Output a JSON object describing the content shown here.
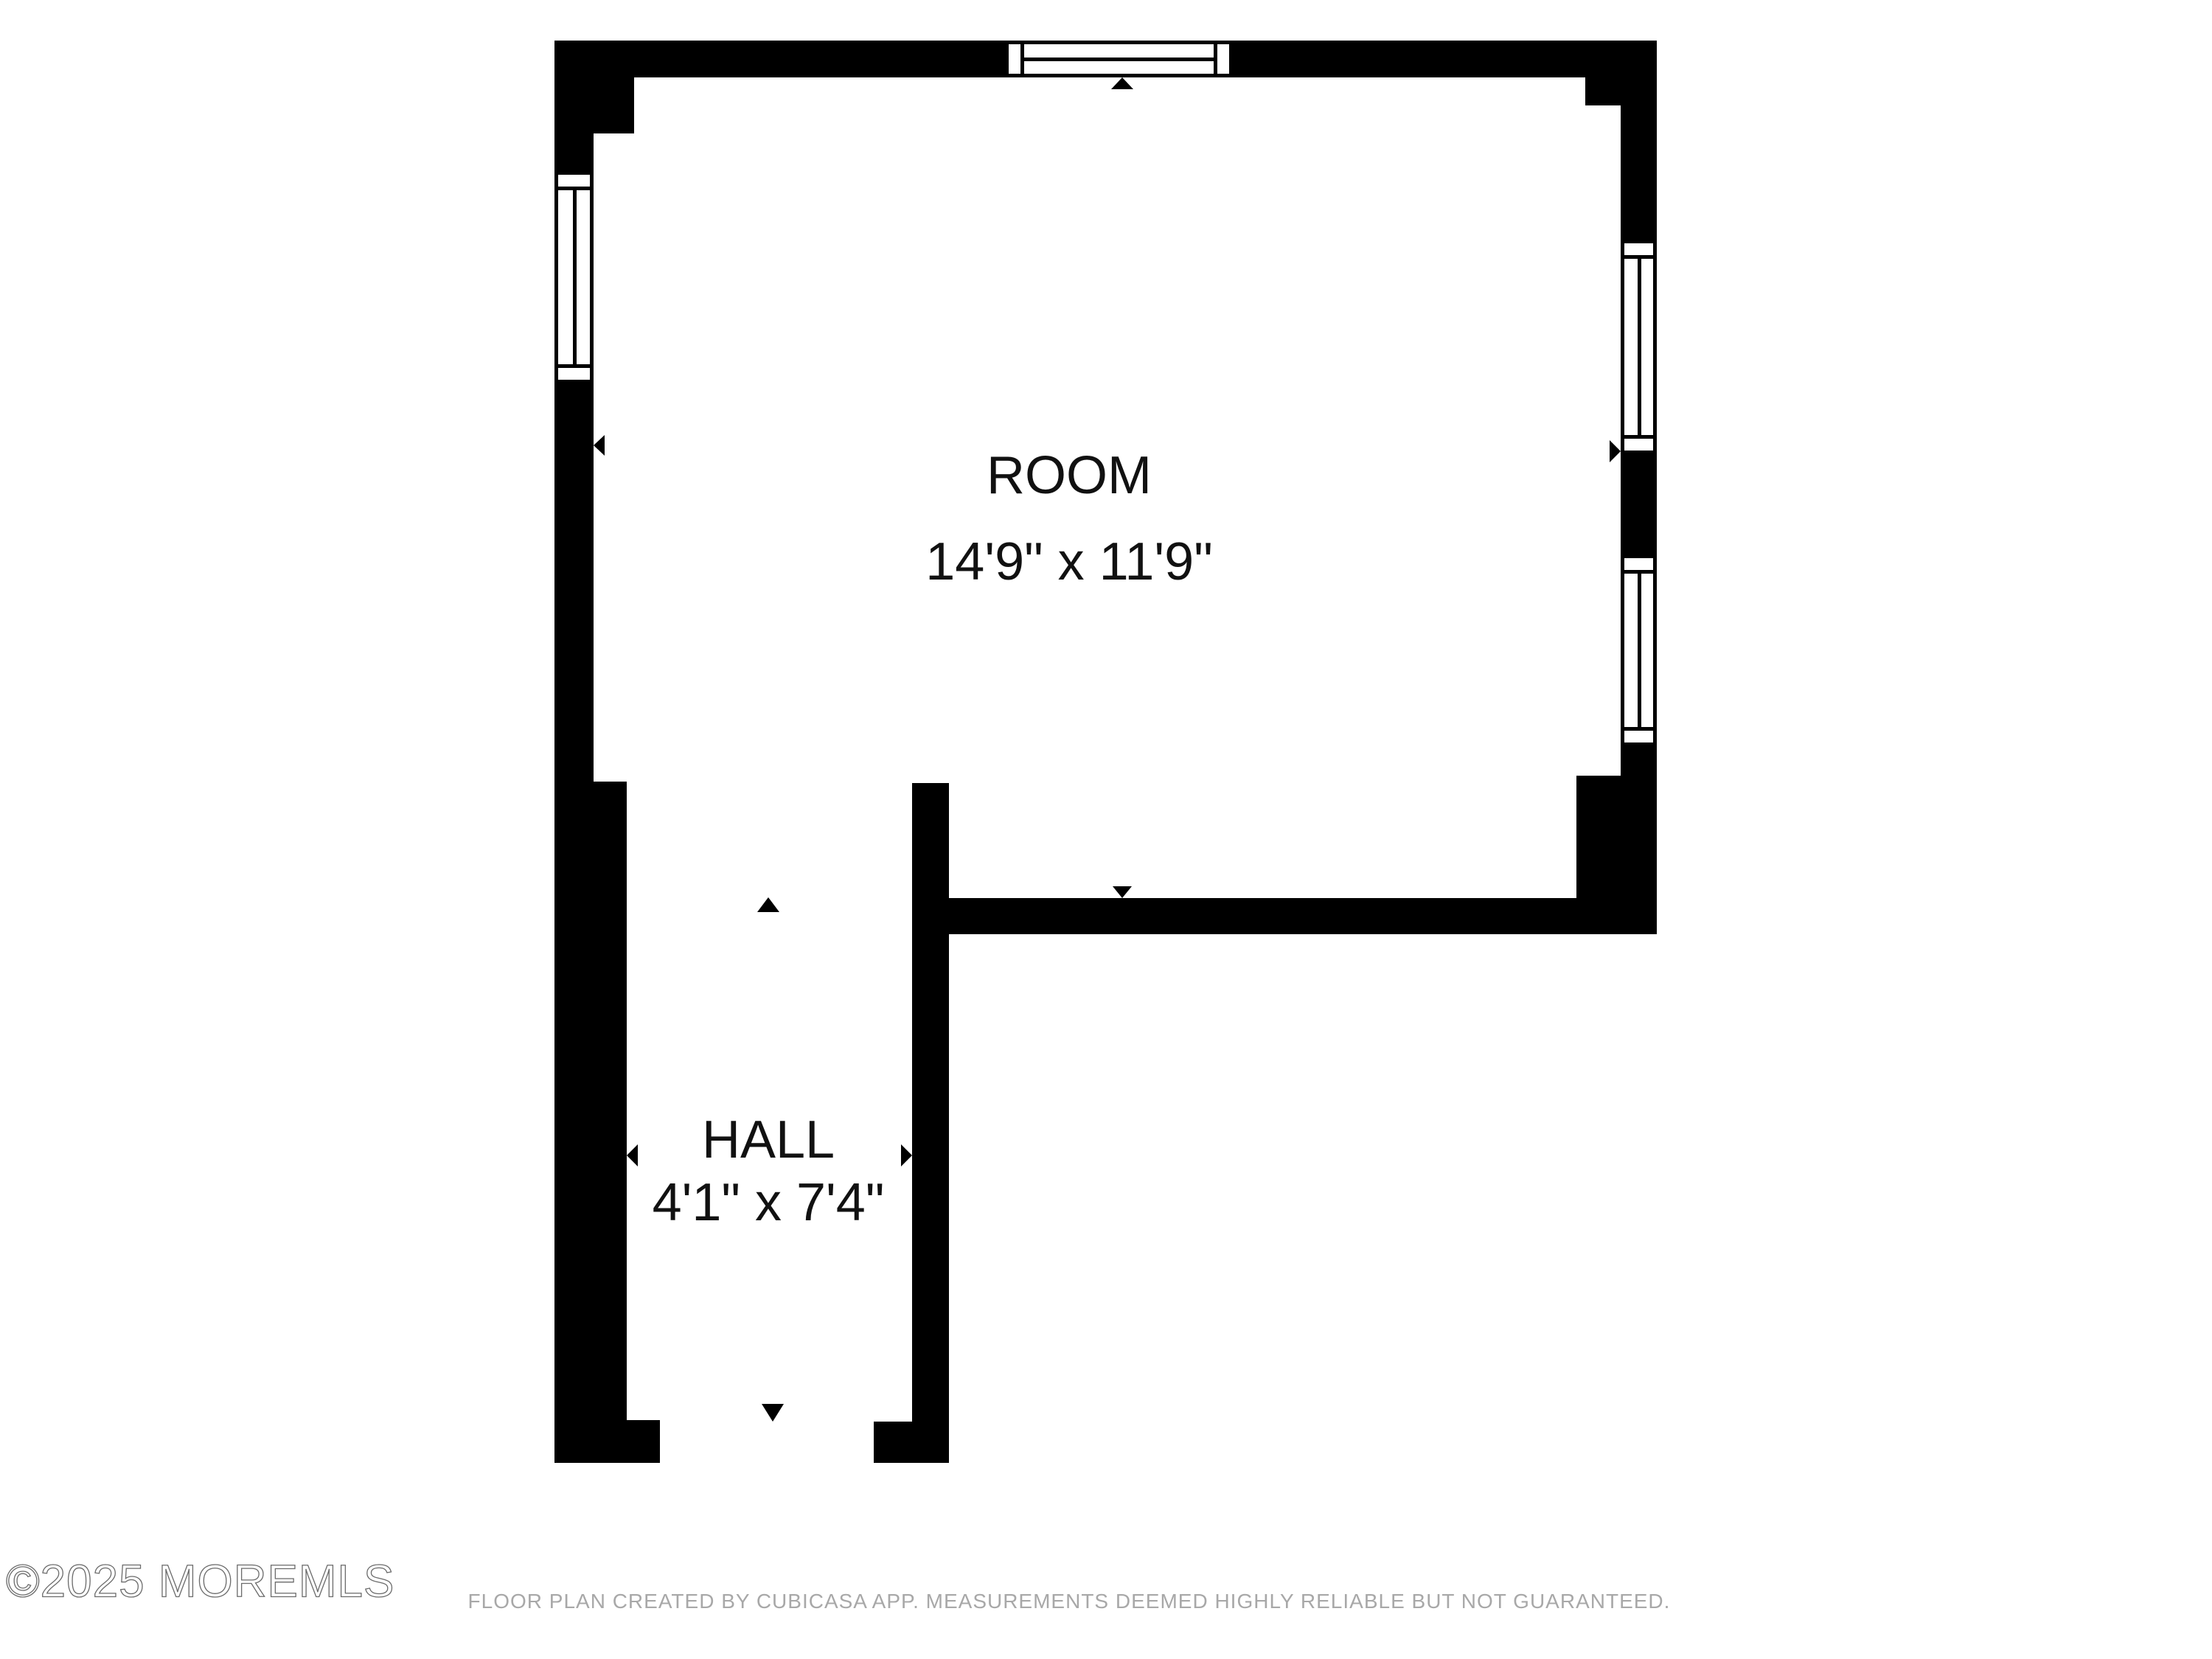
{
  "plan": {
    "rooms": [
      {
        "name": "ROOM",
        "dimensions": "14'9\" x 11'9\""
      },
      {
        "name": "HALL",
        "dimensions": "4'1\" x 7'4\""
      }
    ],
    "windows": [
      {
        "location": "top-wall"
      },
      {
        "location": "left-wall"
      },
      {
        "location": "right-wall-upper"
      },
      {
        "location": "right-wall-lower"
      }
    ],
    "opening_arrows": [
      {
        "direction": "up",
        "location": "top-window"
      },
      {
        "direction": "down",
        "location": "room-bottom-wall"
      },
      {
        "direction": "up",
        "location": "hall-entry"
      },
      {
        "direction": "down",
        "location": "hall-bottom-door"
      },
      {
        "direction": "left",
        "location": "room-left-wall"
      },
      {
        "direction": "right",
        "location": "room-right-wall"
      },
      {
        "direction": "left",
        "location": "hall-left-wall"
      },
      {
        "direction": "right",
        "location": "hall-right-wall"
      }
    ]
  },
  "footer": {
    "watermark": "©2025 MOREMLS",
    "disclaimer": "FLOOR PLAN CREATED BY CUBICASA APP. MEASUREMENTS DEEMED HIGHLY RELIABLE BUT NOT GUARANTEED."
  },
  "colors": {
    "wall": "#000000",
    "background": "#ffffff",
    "label_text": "#111111",
    "disclaimer_text": "#a8a8a8",
    "watermark_stroke": "#6b6b6b"
  }
}
